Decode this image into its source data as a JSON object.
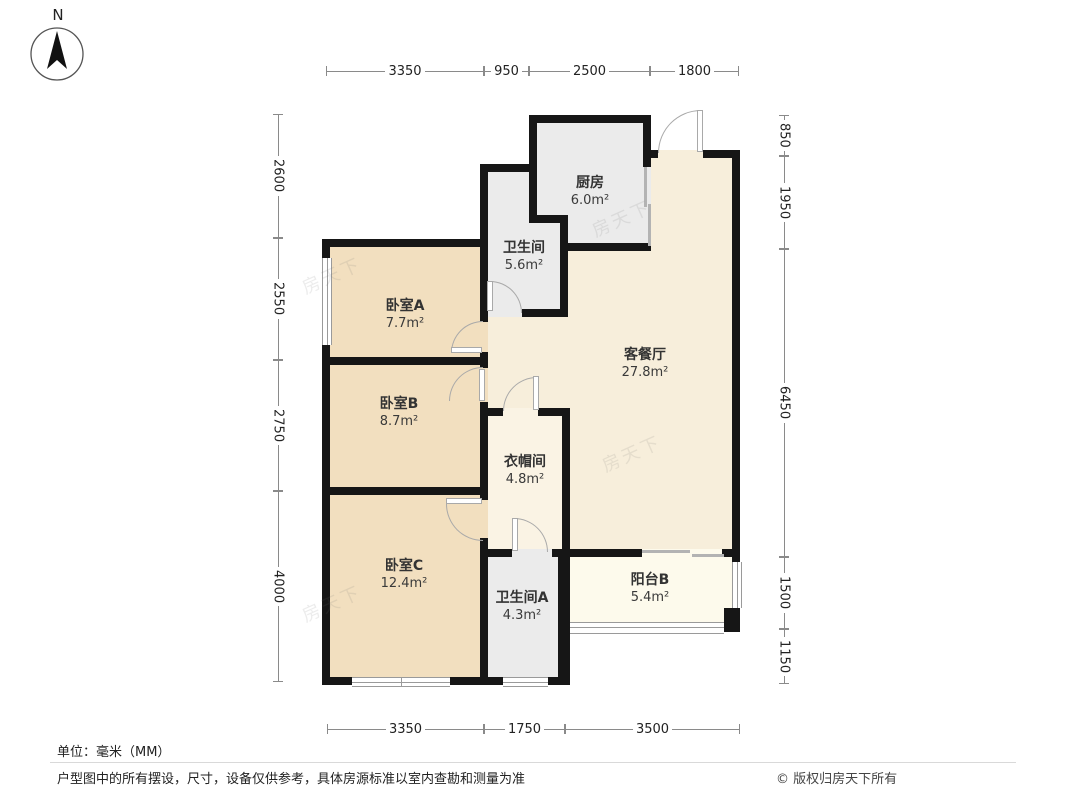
{
  "north_label": "N",
  "watermark": "房天下",
  "rooms": [
    {
      "id": "kitchen",
      "name": "厨房",
      "area": "6.0m²"
    },
    {
      "id": "bathroom",
      "name": "卫生间",
      "area": "5.6m²"
    },
    {
      "id": "bedroom-a",
      "name": "卧室A",
      "area": "7.7m²"
    },
    {
      "id": "living-dining",
      "name": "客餐厅",
      "area": "27.8m²"
    },
    {
      "id": "bedroom-b",
      "name": "卧室B",
      "area": "8.7m²"
    },
    {
      "id": "closet",
      "name": "衣帽间",
      "area": "4.8m²"
    },
    {
      "id": "bedroom-c",
      "name": "卧室C",
      "area": "12.4m²"
    },
    {
      "id": "bathroom-a",
      "name": "卫生间A",
      "area": "4.3m²"
    },
    {
      "id": "balcony-b",
      "name": "阳台B",
      "area": "5.4m²"
    }
  ],
  "dimensions": {
    "top": [
      "3350",
      "950",
      "2500",
      "1800"
    ],
    "bottom": [
      "3350",
      "1750",
      "3500"
    ],
    "left": [
      "2600",
      "2550",
      "2750",
      "4000"
    ],
    "right": [
      "850",
      "1950",
      "6450",
      "1500",
      "1150"
    ]
  },
  "footer": {
    "unit": "单位：毫米（MM）",
    "disclaimer": "户型图中的所有摆设，尺寸，设备仅供参考，具体房源标准以室内查勘和测量为准",
    "copyright": "© 版权归房天下所有"
  },
  "colors": {
    "wall": "#161616",
    "bedroom_floor": "#f2dfbf",
    "living_floor": "#f7eedb",
    "service_floor": "#ebebeb",
    "closet_floor": "#faf3e4",
    "balcony_floor": "#fdfaec",
    "dimension_line": "#8a8a8a",
    "door_line": "#a9a9a9"
  }
}
